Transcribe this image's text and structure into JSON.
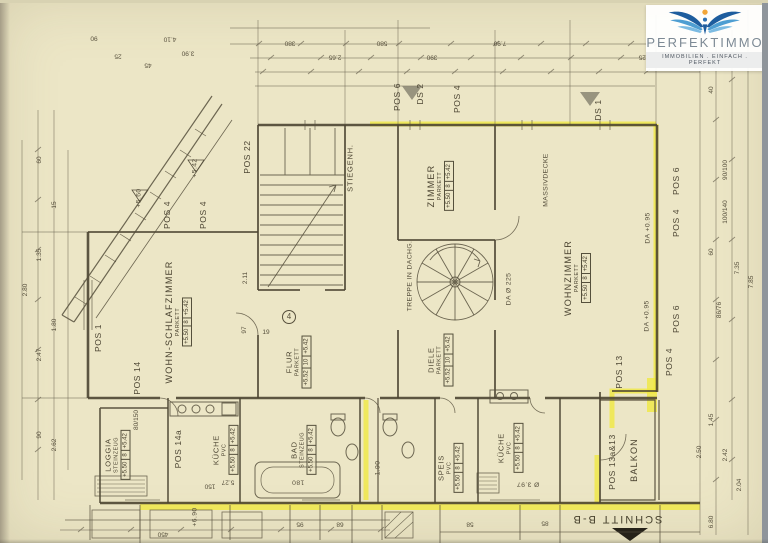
{
  "logo": {
    "brand": "PERFEKTIMMO",
    "tagline": "IMMOBILIEN . EINFACH . PERFEKT",
    "icon": "eagle-sun-icon",
    "colors": {
      "wing_dark": "#1e5d9e",
      "wing_mid": "#4e9ed2",
      "wing_light": "#7cbbe2",
      "sun": "#f2a638"
    }
  },
  "drawing": {
    "paper_color": "#ece6c6",
    "line_color": "#4c4532",
    "highlight_color": "#efe83e",
    "section_label": "SCHNITT B-B",
    "rooms": [
      {
        "name": "WOHN-SCHLAFZIMMER",
        "floor": "PARKETT",
        "levels": [
          "+5.50",
          "8",
          "+5.42"
        ]
      },
      {
        "name": "ZIMMER",
        "floor": "PARKETT",
        "levels": [
          "+5.50",
          "8",
          "+5.42"
        ]
      },
      {
        "name": "WOHNZIMMER",
        "floor": "PARKETT",
        "levels": [
          "+5.50",
          "8",
          "+5.42"
        ]
      },
      {
        "name": "STIEGENH.",
        "floor": "",
        "levels": []
      },
      {
        "name": "FLUR",
        "floor": "PARKETT",
        "levels": [
          "+5.52",
          "10",
          "+5.42"
        ]
      },
      {
        "name": "DIELE",
        "floor": "PARKETT",
        "levels": [
          "+5.52",
          "10",
          "+5.42"
        ]
      },
      {
        "name": "LOGGIA",
        "floor": "STEINZEUG",
        "levels": [
          "+5.50",
          "8",
          "+5.42"
        ]
      },
      {
        "name": "KÜCHE",
        "floor": "PVC",
        "levels": [
          "+5.50",
          "8",
          "+5.42"
        ]
      },
      {
        "name": "BAD",
        "floor": "STEINZEUG",
        "levels": [
          "+5.50",
          "8",
          "+5.42"
        ]
      },
      {
        "name": "SPEIS",
        "floor": "PVC",
        "levels": [
          "+5.50",
          "8",
          "+5.42"
        ]
      },
      {
        "name": "KÜCHE",
        "floor": "PVC",
        "levels": [
          "+5.50",
          "8",
          "+5.42"
        ]
      },
      {
        "name": "BALKON",
        "floor": "",
        "levels": []
      }
    ],
    "annotations": [
      {
        "t": "POS 1",
        "x": 98,
        "y": 338,
        "r": -90,
        "c": "p"
      },
      {
        "t": "POS 14",
        "x": 137,
        "y": 378,
        "r": -90,
        "c": "p"
      },
      {
        "t": "POS 4",
        "x": 167,
        "y": 215,
        "r": -90,
        "c": "p"
      },
      {
        "t": "POS 4",
        "x": 203,
        "y": 215,
        "r": -90,
        "c": "p"
      },
      {
        "t": "POS 22",
        "x": 247,
        "y": 157,
        "r": -90,
        "c": "p"
      },
      {
        "t": "POS 6",
        "x": 397,
        "y": 97,
        "r": -90,
        "c": "p"
      },
      {
        "t": "DS 2",
        "x": 420,
        "y": 94,
        "r": -90,
        "c": "p"
      },
      {
        "t": "POS 4",
        "x": 457,
        "y": 99,
        "r": -90,
        "c": "p"
      },
      {
        "t": "DS 1",
        "x": 598,
        "y": 110,
        "r": -90,
        "c": "p"
      },
      {
        "t": "POS 6",
        "x": 676,
        "y": 181,
        "r": -90,
        "c": "p"
      },
      {
        "t": "POS 4",
        "x": 676,
        "y": 223,
        "r": -90,
        "c": "p"
      },
      {
        "t": "POS 6",
        "x": 676,
        "y": 319,
        "r": -90,
        "c": "p"
      },
      {
        "t": "POS 13",
        "x": 619,
        "y": 372,
        "r": -90,
        "c": "p"
      },
      {
        "t": "POS 4",
        "x": 669,
        "y": 362,
        "r": -90,
        "c": "p"
      },
      {
        "t": "POS 13a&13",
        "x": 612,
        "y": 462,
        "r": -90,
        "c": "p"
      },
      {
        "t": "POS 14a",
        "x": 178,
        "y": 449,
        "r": -90,
        "c": "p"
      },
      {
        "t": "TREPPE IN DACHG.",
        "x": 411,
        "y": 276,
        "r": -90,
        "c": "n"
      },
      {
        "t": "DA Ø 225",
        "x": 510,
        "y": 289,
        "r": -90,
        "c": "n"
      },
      {
        "t": "MASSIVDECKE",
        "x": 547,
        "y": 180,
        "r": -90,
        "c": "n"
      },
      {
        "t": "DA +0.95",
        "x": 649,
        "y": 228,
        "r": -90,
        "c": "n"
      },
      {
        "t": "DA +0.95",
        "x": 648,
        "y": 316,
        "r": -90,
        "c": "n"
      },
      {
        "t": "+5.42",
        "x": 196,
        "y": 168,
        "r": -90,
        "c": "n"
      },
      {
        "t": "+5.60",
        "x": 140,
        "y": 198,
        "r": -90,
        "c": "n"
      },
      {
        "t": "180",
        "x": 298,
        "y": 481,
        "r": 180,
        "c": "n"
      },
      {
        "t": "Ø 3.97",
        "x": 528,
        "y": 483,
        "r": 180,
        "c": "n"
      },
      {
        "t": "1.90",
        "x": 379,
        "y": 468,
        "r": -90,
        "c": "n"
      },
      {
        "t": "+6.90",
        "x": 196,
        "y": 517,
        "r": -90,
        "c": "n"
      },
      {
        "t": "4",
        "x": 289,
        "y": 317,
        "r": 0,
        "c": "circ"
      },
      {
        "t": "90",
        "x": 94,
        "y": 37,
        "r": 180,
        "c": "d"
      },
      {
        "t": "25",
        "x": 118,
        "y": 55,
        "r": 180,
        "c": "d"
      },
      {
        "t": "4.10",
        "x": 170,
        "y": 38,
        "r": 180,
        "c": "d"
      },
      {
        "t": "3.90",
        "x": 188,
        "y": 52,
        "r": 180,
        "c": "d"
      },
      {
        "t": "45",
        "x": 148,
        "y": 64,
        "r": 180,
        "c": "d"
      },
      {
        "t": "380",
        "x": 290,
        "y": 42,
        "r": 180,
        "c": "d"
      },
      {
        "t": "2.65",
        "x": 335,
        "y": 56,
        "r": 180,
        "c": "d"
      },
      {
        "t": "580",
        "x": 382,
        "y": 42,
        "r": 180,
        "c": "d"
      },
      {
        "t": "390",
        "x": 432,
        "y": 56,
        "r": 180,
        "c": "d"
      },
      {
        "t": "7.90",
        "x": 500,
        "y": 42,
        "r": 180,
        "c": "d"
      },
      {
        "t": "4.25",
        "x": 645,
        "y": 56,
        "r": 180,
        "c": "d"
      },
      {
        "t": "2.80",
        "x": 26,
        "y": 290,
        "r": -90,
        "c": "d"
      },
      {
        "t": "60",
        "x": 40,
        "y": 160,
        "r": -90,
        "c": "d"
      },
      {
        "t": "1.35",
        "x": 40,
        "y": 255,
        "r": -90,
        "c": "d"
      },
      {
        "t": "2.47",
        "x": 40,
        "y": 355,
        "r": -90,
        "c": "d"
      },
      {
        "t": "90",
        "x": 40,
        "y": 435,
        "r": -90,
        "c": "d"
      },
      {
        "t": "15",
        "x": 55,
        "y": 205,
        "r": -90,
        "c": "d"
      },
      {
        "t": "1.80",
        "x": 55,
        "y": 325,
        "r": -90,
        "c": "d"
      },
      {
        "t": "2.62",
        "x": 55,
        "y": 445,
        "r": -90,
        "c": "d"
      },
      {
        "t": "40",
        "x": 712,
        "y": 90,
        "r": -90,
        "c": "d"
      },
      {
        "t": "90/100",
        "x": 726,
        "y": 170,
        "r": -90,
        "c": "d"
      },
      {
        "t": "100/140",
        "x": 726,
        "y": 212,
        "r": -90,
        "c": "d"
      },
      {
        "t": "60",
        "x": 712,
        "y": 252,
        "r": -90,
        "c": "d"
      },
      {
        "t": "86/76",
        "x": 720,
        "y": 310,
        "r": -90,
        "c": "d"
      },
      {
        "t": "7.35",
        "x": 738,
        "y": 268,
        "r": -90,
        "c": "d"
      },
      {
        "t": "7.85",
        "x": 752,
        "y": 282,
        "r": -90,
        "c": "d"
      },
      {
        "t": "2.50",
        "x": 700,
        "y": 452,
        "r": -90,
        "c": "d"
      },
      {
        "t": "1.45",
        "x": 712,
        "y": 420,
        "r": -90,
        "c": "d"
      },
      {
        "t": "2.42",
        "x": 726,
        "y": 455,
        "r": -90,
        "c": "d"
      },
      {
        "t": "2.04",
        "x": 740,
        "y": 485,
        "r": -90,
        "c": "d"
      },
      {
        "t": "6.80",
        "x": 712,
        "y": 522,
        "r": -90,
        "c": "d"
      },
      {
        "t": "450",
        "x": 163,
        "y": 533,
        "r": 180,
        "c": "d"
      },
      {
        "t": "150",
        "x": 210,
        "y": 485,
        "r": 180,
        "c": "d"
      },
      {
        "t": "5.27",
        "x": 228,
        "y": 481,
        "r": 180,
        "c": "d"
      },
      {
        "t": "95",
        "x": 300,
        "y": 523,
        "r": 180,
        "c": "d"
      },
      {
        "t": "68",
        "x": 340,
        "y": 523,
        "r": 180,
        "c": "d"
      },
      {
        "t": "58",
        "x": 470,
        "y": 523,
        "r": 180,
        "c": "d"
      },
      {
        "t": "85",
        "x": 545,
        "y": 522,
        "r": 180,
        "c": "d"
      },
      {
        "t": "2.11",
        "x": 246,
        "y": 278,
        "r": -90,
        "c": "d"
      },
      {
        "t": "97",
        "x": 245,
        "y": 330,
        "r": -90,
        "c": "d"
      },
      {
        "t": "19",
        "x": 266,
        "y": 333,
        "r": 0,
        "c": "d"
      },
      {
        "t": "80/150",
        "x": 137,
        "y": 420,
        "r": -90,
        "c": "d"
      }
    ]
  }
}
